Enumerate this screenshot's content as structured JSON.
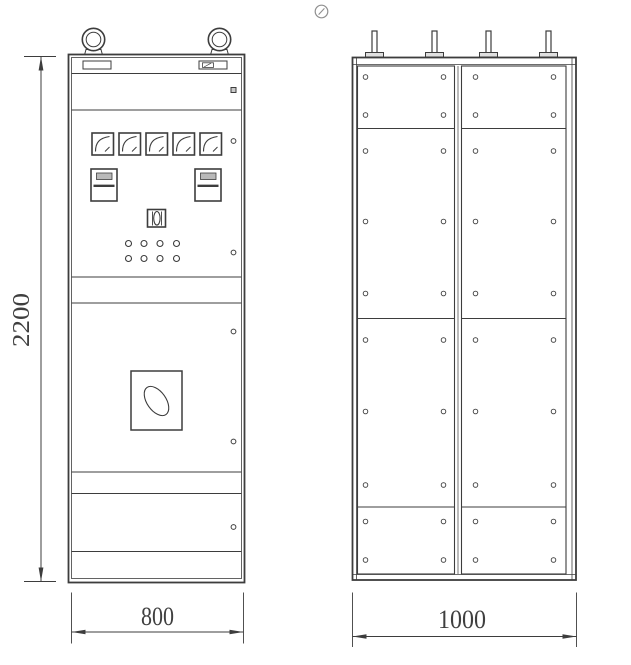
{
  "document": {
    "type": "technical-drawing"
  },
  "dimensions": {
    "overall_height_mm": "2200",
    "front_width_mm": "800",
    "rear_width_mm": "1000"
  },
  "front_view": {
    "lifting_eyes": 2,
    "nameplates": 2,
    "panel_meters": 5,
    "energy_meters": 2,
    "control_switch": 1,
    "indicator_lamps": 8,
    "door_handle": 1,
    "door_fasteners": 5,
    "door_lock": 1
  },
  "rear_view": {
    "terminal_studs": 4,
    "door_panels": 2,
    "panel_bolts": 40
  },
  "icons": {
    "watermark": "circled-slash-icon"
  },
  "colors": {
    "line": "#3d3d3d",
    "background": "#ffffff",
    "watermark": "#8f8f8f"
  }
}
